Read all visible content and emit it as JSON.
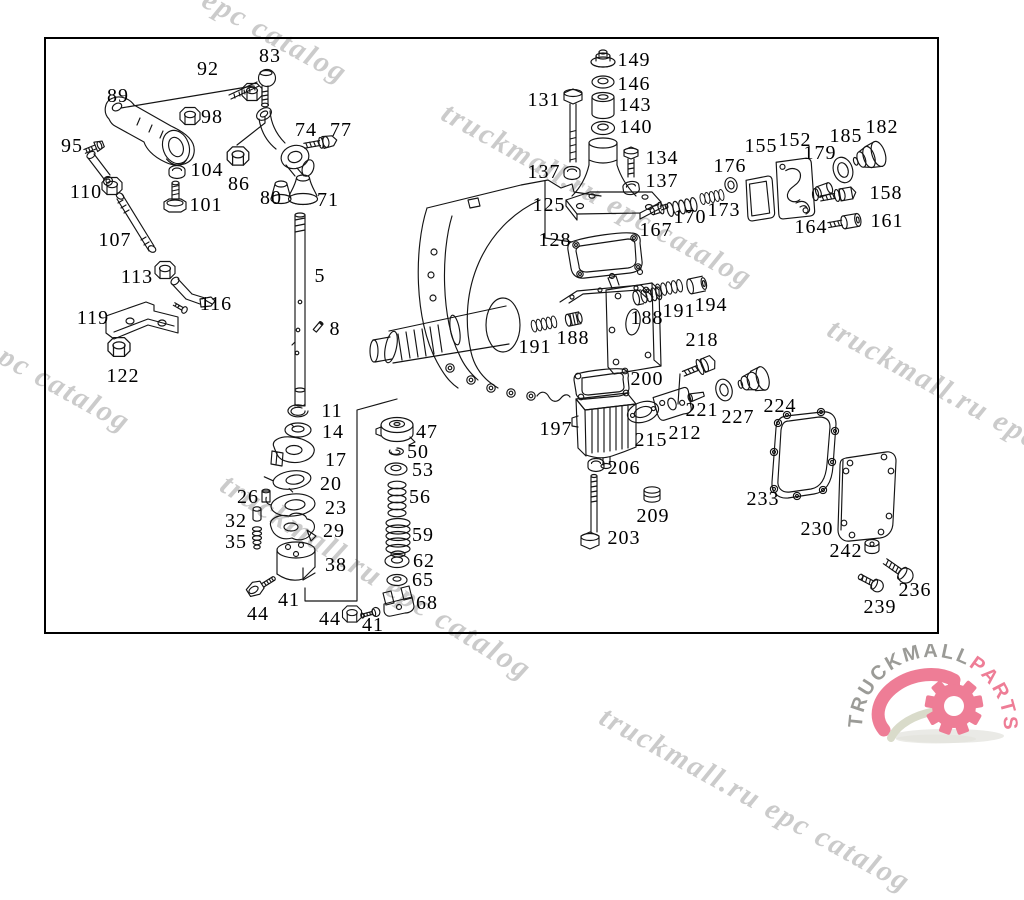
{
  "diagram": {
    "labels": [
      {
        "text": "83",
        "x": 270,
        "y": 56
      },
      {
        "text": "92",
        "x": 208,
        "y": 69
      },
      {
        "text": "89",
        "x": 118,
        "y": 96
      },
      {
        "text": "98",
        "x": 212,
        "y": 117
      },
      {
        "text": "74",
        "x": 306,
        "y": 130
      },
      {
        "text": "77",
        "x": 341,
        "y": 130
      },
      {
        "text": "95",
        "x": 72,
        "y": 146
      },
      {
        "text": "104",
        "x": 207,
        "y": 170
      },
      {
        "text": "86",
        "x": 239,
        "y": 184
      },
      {
        "text": "110",
        "x": 86,
        "y": 192
      },
      {
        "text": "80",
        "x": 271,
        "y": 198
      },
      {
        "text": "71",
        "x": 328,
        "y": 200
      },
      {
        "text": "101",
        "x": 206,
        "y": 205
      },
      {
        "text": "107",
        "x": 115,
        "y": 240
      },
      {
        "text": "113",
        "x": 137,
        "y": 277
      },
      {
        "text": "5",
        "x": 320,
        "y": 276
      },
      {
        "text": "116",
        "x": 216,
        "y": 304
      },
      {
        "text": "8",
        "x": 335,
        "y": 329
      },
      {
        "text": "119",
        "x": 93,
        "y": 318
      },
      {
        "text": "122",
        "x": 123,
        "y": 376
      },
      {
        "text": "131",
        "x": 544,
        "y": 100
      },
      {
        "text": "149",
        "x": 634,
        "y": 60
      },
      {
        "text": "146",
        "x": 634,
        "y": 84
      },
      {
        "text": "143",
        "x": 635,
        "y": 105
      },
      {
        "text": "140",
        "x": 636,
        "y": 127
      },
      {
        "text": "134",
        "x": 662,
        "y": 158
      },
      {
        "text": "137",
        "x": 544,
        "y": 172
      },
      {
        "text": "137",
        "x": 662,
        "y": 181
      },
      {
        "text": "125",
        "x": 549,
        "y": 205
      },
      {
        "text": "128",
        "x": 555,
        "y": 240
      },
      {
        "text": "167",
        "x": 656,
        "y": 230
      },
      {
        "text": "170",
        "x": 690,
        "y": 217
      },
      {
        "text": "173",
        "x": 724,
        "y": 210
      },
      {
        "text": "176",
        "x": 730,
        "y": 166
      },
      {
        "text": "155",
        "x": 761,
        "y": 146
      },
      {
        "text": "152",
        "x": 795,
        "y": 140
      },
      {
        "text": "179",
        "x": 820,
        "y": 153
      },
      {
        "text": "185",
        "x": 846,
        "y": 136
      },
      {
        "text": "182",
        "x": 882,
        "y": 127
      },
      {
        "text": "158",
        "x": 886,
        "y": 193
      },
      {
        "text": "164",
        "x": 811,
        "y": 227
      },
      {
        "text": "161",
        "x": 887,
        "y": 221
      },
      {
        "text": "188",
        "x": 647,
        "y": 318
      },
      {
        "text": "191",
        "x": 679,
        "y": 311
      },
      {
        "text": "194",
        "x": 711,
        "y": 305
      },
      {
        "text": "188",
        "x": 573,
        "y": 338
      },
      {
        "text": "191",
        "x": 535,
        "y": 347
      },
      {
        "text": "218",
        "x": 702,
        "y": 340
      },
      {
        "text": "200",
        "x": 647,
        "y": 379
      },
      {
        "text": "221",
        "x": 702,
        "y": 410
      },
      {
        "text": "227",
        "x": 738,
        "y": 417
      },
      {
        "text": "197",
        "x": 556,
        "y": 429
      },
      {
        "text": "215",
        "x": 651,
        "y": 440
      },
      {
        "text": "212",
        "x": 685,
        "y": 433
      },
      {
        "text": "224",
        "x": 780,
        "y": 406
      },
      {
        "text": "206",
        "x": 624,
        "y": 468
      },
      {
        "text": "209",
        "x": 653,
        "y": 516
      },
      {
        "text": "203",
        "x": 624,
        "y": 538
      },
      {
        "text": "233",
        "x": 763,
        "y": 499
      },
      {
        "text": "230",
        "x": 817,
        "y": 529
      },
      {
        "text": "242",
        "x": 846,
        "y": 551
      },
      {
        "text": "236",
        "x": 915,
        "y": 590
      },
      {
        "text": "239",
        "x": 880,
        "y": 607
      },
      {
        "text": "11",
        "x": 332,
        "y": 411
      },
      {
        "text": "14",
        "x": 333,
        "y": 432
      },
      {
        "text": "17",
        "x": 336,
        "y": 460
      },
      {
        "text": "20",
        "x": 331,
        "y": 484
      },
      {
        "text": "23",
        "x": 336,
        "y": 508
      },
      {
        "text": "26",
        "x": 248,
        "y": 497
      },
      {
        "text": "29",
        "x": 334,
        "y": 531
      },
      {
        "text": "32",
        "x": 236,
        "y": 521
      },
      {
        "text": "35",
        "x": 236,
        "y": 542
      },
      {
        "text": "38",
        "x": 336,
        "y": 565
      },
      {
        "text": "41",
        "x": 289,
        "y": 600
      },
      {
        "text": "44",
        "x": 258,
        "y": 614
      },
      {
        "text": "44",
        "x": 330,
        "y": 619
      },
      {
        "text": "41",
        "x": 373,
        "y": 625
      },
      {
        "text": "47",
        "x": 427,
        "y": 432
      },
      {
        "text": "50",
        "x": 418,
        "y": 452
      },
      {
        "text": "53",
        "x": 423,
        "y": 470
      },
      {
        "text": "56",
        "x": 420,
        "y": 497
      },
      {
        "text": "59",
        "x": 423,
        "y": 535
      },
      {
        "text": "62",
        "x": 424,
        "y": 561
      },
      {
        "text": "65",
        "x": 423,
        "y": 580
      },
      {
        "text": "68",
        "x": 427,
        "y": 603
      }
    ]
  },
  "watermarks": {
    "text": "truckmall.ru epc catalog",
    "color": "#c9c9c9",
    "items": [
      {
        "x": 47,
        "y": -109,
        "angle": 29,
        "size": 30
      },
      {
        "x": 452,
        "y": 96,
        "angle": 29,
        "size": 30
      },
      {
        "x": 838,
        "y": 312,
        "angle": 29,
        "size": 30
      },
      {
        "x": -170,
        "y": 240,
        "angle": 29,
        "size": 30
      },
      {
        "x": 233,
        "y": 466,
        "angle": 32,
        "size": 31
      },
      {
        "x": 610,
        "y": 700,
        "angle": 29,
        "size": 30
      }
    ]
  },
  "logo": {
    "text_primary": "TRUCKMALL",
    "text_secondary": "PARTS",
    "color_primary": "#9b9b97",
    "color_secondary": "#ee7d96"
  }
}
